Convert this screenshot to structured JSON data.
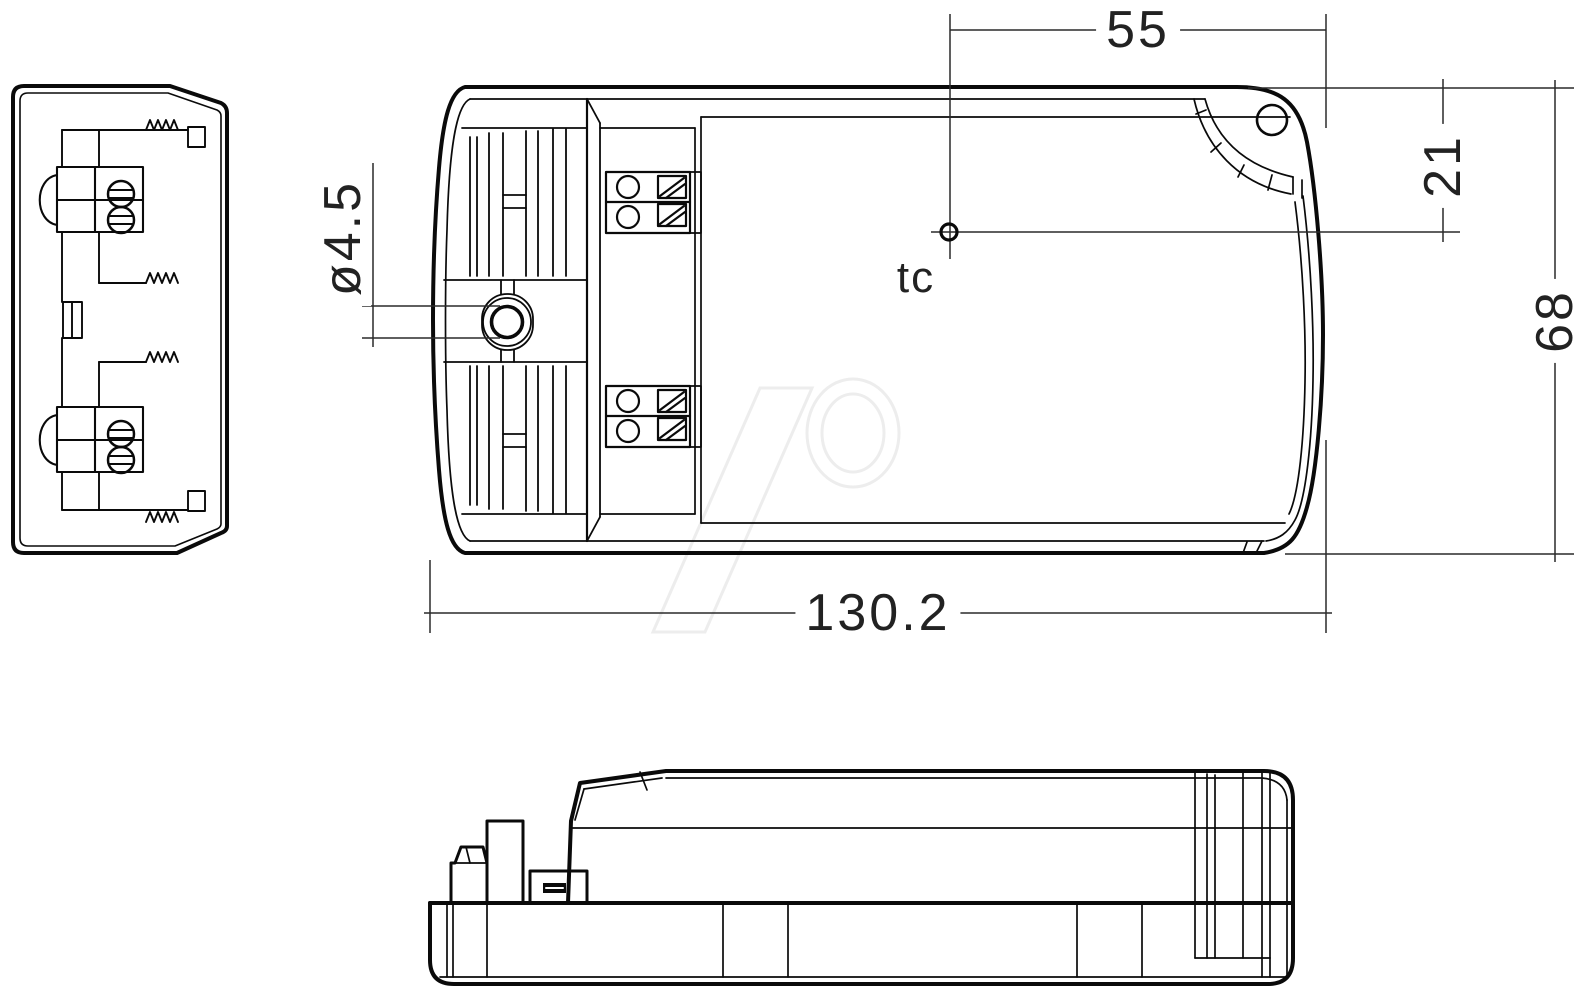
{
  "drawing": {
    "labels": {
      "dim_top_width": "55",
      "dim_hole_offset": "21",
      "dim_height": "68",
      "dim_length": "130.2",
      "dim_mount_hole_diameter": "ø4.5",
      "thermal_reference_point": "tc"
    },
    "colors": {
      "line": "#0a0a0a",
      "dimension_line": "#2a2a2a",
      "dimension_text": "#222222",
      "watermark": "#ededed",
      "background": "#ffffff"
    }
  }
}
